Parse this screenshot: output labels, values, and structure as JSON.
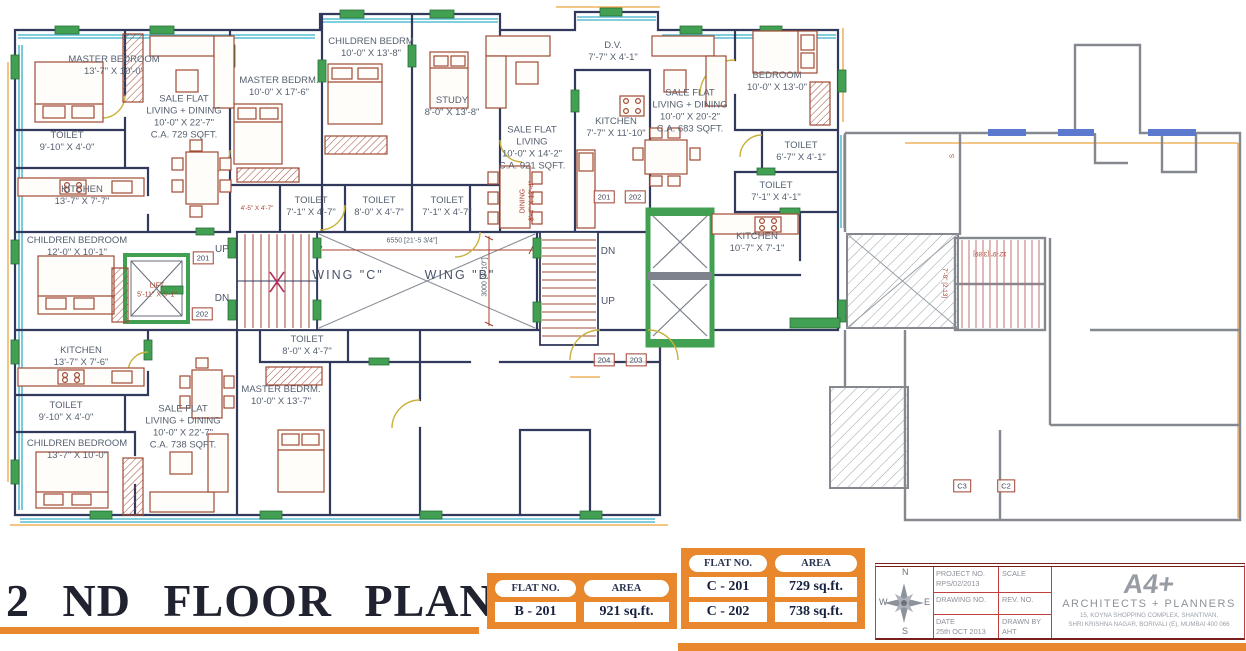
{
  "title": "2 ND FLOOR PLAN",
  "plan": {
    "labels": [
      {
        "name": "room-master-bedroom-tl",
        "x": 114,
        "y": 66,
        "lines": [
          "MASTER BEDROOM",
          "13'-7\" X 10'-0\""
        ]
      },
      {
        "name": "room-toilet-tl",
        "x": 67,
        "y": 142,
        "lines": [
          "TOILET",
          "9'-10\" X 4'-0\""
        ]
      },
      {
        "name": "room-kitchen-tl",
        "x": 82,
        "y": 196,
        "lines": [
          "KITCHEN",
          "13'-7\" X 7'-7\""
        ]
      },
      {
        "name": "room-children-bedroom-tl",
        "x": 77,
        "y": 247,
        "lines": [
          "CHILDREN BEDROOM",
          "12'-0\" X 10'-1\""
        ]
      },
      {
        "name": "room-sale-flat-729",
        "x": 184,
        "y": 117,
        "lines": [
          "SALE FLAT",
          "LIVING + DINING",
          "10'-0\" X 22'-7\"",
          "C.A. 729 SQFT."
        ]
      },
      {
        "name": "room-master-bedrm-mid",
        "x": 279,
        "y": 87,
        "lines": [
          "MASTER BEDRM.",
          "10'-0\" X 17'-6\""
        ]
      },
      {
        "name": "room-children-bedrm-mid",
        "x": 371,
        "y": 48,
        "lines": [
          "CHILDREN BEDRM",
          "10'-0\" X 13'-8\""
        ]
      },
      {
        "name": "room-study",
        "x": 452,
        "y": 107,
        "lines": [
          "STUDY",
          "8'-0\" X 13'-8\""
        ]
      },
      {
        "name": "room-sale-flat-921",
        "x": 532,
        "y": 148,
        "lines": [
          "SALE FLAT",
          "LIVING",
          "10'-0\" X 14'-2\"",
          "C.A. 921 SQFT."
        ]
      },
      {
        "name": "room-dv",
        "x": 613,
        "y": 52,
        "lines": [
          "D.V.",
          "7'-7\" X 4'-1\""
        ]
      },
      {
        "name": "room-kitchen-mid",
        "x": 616,
        "y": 128,
        "lines": [
          "KITCHEN",
          "7'-7\" X 11'-10\""
        ]
      },
      {
        "name": "room-sale-flat-683",
        "x": 690,
        "y": 111,
        "lines": [
          "SALE FLAT",
          "LIVING + DINING",
          "10'-0\" X 20'-2\"",
          "C.A. 683 SQFT."
        ]
      },
      {
        "name": "room-bedroom-right",
        "x": 777,
        "y": 82,
        "lines": [
          "BEDROOM",
          "10'-0\" X 13'-0\""
        ]
      },
      {
        "name": "room-toilet-r1",
        "x": 801,
        "y": 152,
        "lines": [
          "TOILET",
          "6'-7\" X 4'-1\""
        ]
      },
      {
        "name": "room-toilet-r2",
        "x": 776,
        "y": 192,
        "lines": [
          "TOILET",
          "7'-1\" X 4'-1\""
        ]
      },
      {
        "name": "room-kitchen-right",
        "x": 757,
        "y": 243,
        "lines": [
          "KITCHEN",
          "10'-7\" X 7'-1\""
        ]
      },
      {
        "name": "room-toilet-m1",
        "x": 311,
        "y": 207,
        "lines": [
          "TOILET",
          "7'-1\" X 4'-7\""
        ]
      },
      {
        "name": "room-toilet-m2",
        "x": 379,
        "y": 207,
        "lines": [
          "TOILET",
          "8'-0\" X 4'-7\""
        ]
      },
      {
        "name": "room-toilet-m3",
        "x": 447,
        "y": 207,
        "lines": [
          "TOILET",
          "7'-1\" X 4'-7\""
        ]
      },
      {
        "name": "dim-duct",
        "cls": "dim tiny",
        "x": 257,
        "y": 209,
        "lines": [
          "4'-5\" X 4'-7\""
        ]
      },
      {
        "name": "wing-c-label",
        "cls": "wing",
        "x": 348,
        "y": 276,
        "lines": [
          "WING \"C\""
        ]
      },
      {
        "name": "wing-b-label",
        "cls": "wing",
        "x": 460,
        "y": 276,
        "lines": [
          "WING \"B\""
        ]
      },
      {
        "name": "dim-6550",
        "cls": "small",
        "x": 412,
        "y": 242,
        "lines": [
          "6550 [21'-5 3/4\"]"
        ]
      },
      {
        "name": "dim-3000",
        "cls": "small",
        "x": 486,
        "y": 277,
        "rot": -90,
        "lines": [
          "3000 [9'-10\"]"
        ]
      },
      {
        "name": "stair-up-left",
        "cls": "updn",
        "x": 222,
        "y": 250,
        "lines": [
          "UP"
        ]
      },
      {
        "name": "stair-dn-left",
        "cls": "updn",
        "x": 222,
        "y": 299,
        "lines": [
          "DN"
        ]
      },
      {
        "name": "stair-dn-right",
        "cls": "updn",
        "x": 608,
        "y": 252,
        "lines": [
          "DN"
        ]
      },
      {
        "name": "stair-up-right",
        "cls": "updn",
        "x": 608,
        "y": 302,
        "lines": [
          "UP"
        ]
      },
      {
        "name": "room-lift",
        "cls": "dim small",
        "x": 157,
        "y": 291,
        "lines": [
          "LIFT",
          "5'-11\" X 5'-1\""
        ]
      },
      {
        "name": "room-toilet-bottom-mid",
        "x": 307,
        "y": 346,
        "lines": [
          "TOILET",
          "8'-0\" X 4'-7\""
        ]
      },
      {
        "name": "room-master-bedrm-bottom",
        "x": 281,
        "y": 396,
        "lines": [
          "MASTER BEDRM.",
          "10'-0\" X 13'-7\""
        ]
      },
      {
        "name": "room-kitchen-bl",
        "x": 81,
        "y": 357,
        "lines": [
          "KITCHEN",
          "13'-7\" X 7'-6\""
        ]
      },
      {
        "name": "room-toilet-bl",
        "x": 66,
        "y": 412,
        "lines": [
          "TOILET",
          "9'-10\" X 4'-0\""
        ]
      },
      {
        "name": "room-children-bedroom-bl",
        "x": 77,
        "y": 450,
        "lines": [
          "CHILDREN BEDROOM",
          "13'-7\" X 10'-0\""
        ]
      },
      {
        "name": "room-sale-flat-738",
        "x": 183,
        "y": 427,
        "lines": [
          "SALE FLAT",
          "LIVING + DINING",
          "10'-0\" X 22'-7\"",
          "C.A. 738 SQFT."
        ]
      },
      {
        "name": "room-dining-vertical",
        "cls": "dim small",
        "x": 528,
        "y": 201,
        "rot": -90,
        "lines": [
          "DINING",
          "8'-4\" X 12'-4\""
        ]
      },
      {
        "name": "dim-12-9",
        "cls": "dim tiny",
        "x": 990,
        "y": 253,
        "rot": 180,
        "lines": [
          "12'-9\" [3.89]"
        ]
      },
      {
        "name": "dim-7-0",
        "cls": "dim tiny",
        "x": 944,
        "y": 283,
        "rot": 90,
        "lines": [
          "7'-0\" [2.13]"
        ]
      },
      {
        "name": "wall-tag-s",
        "cls": "dim tiny",
        "x": 953,
        "y": 156,
        "rot": -90,
        "lines": [
          "S"
        ]
      }
    ],
    "plates": [
      {
        "text": "201",
        "x": 203,
        "y": 258
      },
      {
        "text": "202",
        "x": 202,
        "y": 314
      },
      {
        "text": "201",
        "x": 604,
        "y": 197
      },
      {
        "text": "202",
        "x": 635,
        "y": 197
      },
      {
        "text": "204",
        "x": 604,
        "y": 360
      },
      {
        "text": "203",
        "x": 636,
        "y": 360
      },
      {
        "text": "C3",
        "x": 962,
        "y": 486
      },
      {
        "text": "C2",
        "x": 1006,
        "y": 486
      }
    ]
  },
  "tables": {
    "b": {
      "headers": [
        "FLAT NO.",
        "AREA"
      ],
      "rows": [
        [
          "B - 201",
          "921 sq.ft."
        ]
      ]
    },
    "c": {
      "headers": [
        "FLAT NO.",
        "AREA"
      ],
      "rows": [
        [
          "C - 201",
          "729 sq.ft."
        ],
        [
          "C - 202",
          "738 sq.ft."
        ]
      ]
    }
  },
  "title_block": {
    "project_no_label": "PROJECT NO.",
    "project_no": "RPS/02/2013",
    "scale_label": "SCALE",
    "drawing_no_label": "DRAWING NO.",
    "rev_no_label": "REV. NO.",
    "date_label": "DATE",
    "date": "25th OCT 2013",
    "drawn_by_label": "DRAWN BY",
    "drawn_by": "AHT"
  },
  "compass": {
    "n": "N",
    "e": "E",
    "s": "S",
    "w": "W"
  },
  "firm": {
    "logo": "A4+",
    "name": "ARCHITECTS + PLANNERS",
    "address1": "15, KOYNA SHOPPING COMPLEX, SHANTIVAN,",
    "address2": "SHRI KRISHNA NAGAR, BORIVALI (E), MUMBAI 400 066"
  },
  "colors": {
    "wall": "#313a5c",
    "existing_wall": "#85898f",
    "green_marker": "#41a052",
    "orange": "#e8872b",
    "furniture": "#a04a35",
    "window_cyan": "#59bdd1",
    "window_blue": "#5b79ce",
    "dim_red": "#a8402e",
    "label": "#566070"
  }
}
